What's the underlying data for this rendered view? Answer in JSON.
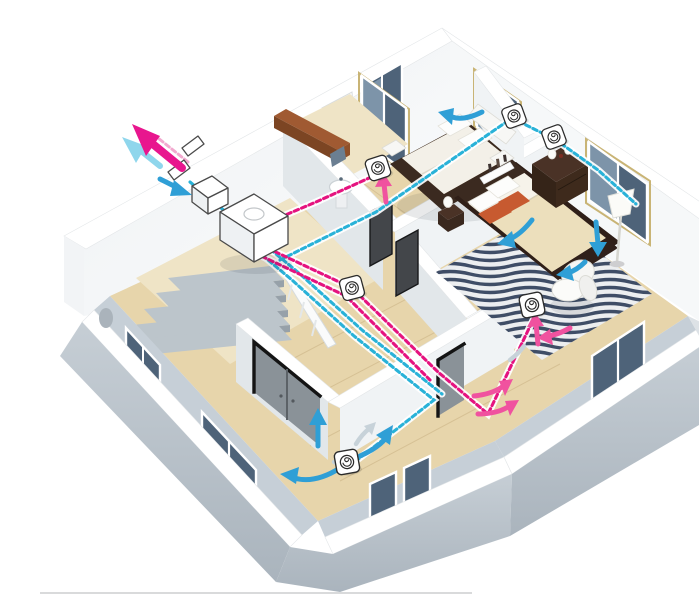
{
  "meta": {
    "alt": "3D cutaway illustration of a single-storey house interior showing a heat-recovery ventilation system: a white HRV unit near the entrance, cyan dashed supply-air ducts and magenta dashed extract-air ducts running over the cut wall tops, round ceiling diffusers in the hallway, bedrooms and living room, blue supply airflow arrows, pink extract airflow arrows, and exterior intake/exhaust arrows through the wall grilles",
    "visible_text": "none"
  },
  "colors": {
    "innerBand": "#c6cfd7",
    "backWall2": "#f6f8f9",
    "wallShade": "#e2e7ea",
    "wallShade2": "#f0f3f5",
    "floorWood": "#e7d5ab",
    "floorPale": "#efe4c6",
    "plank": "#c9b183",
    "glassDark": "#4e6379",
    "glassLight": "#7d94a9",
    "frameTan": "#c9b475",
    "stairTread": "#bcc5cb",
    "stairRiser": "#97a1a9",
    "doorPanel": "#8a9298",
    "doorFrame": "#141414",
    "supply": "#29b2d8",
    "supplyLight": "#8fd6ec",
    "extract": "#e5137f",
    "extractLight": "#f2a9cf",
    "extractBright": "#f0529f",
    "arrowBlue": "#2f9fd6",
    "arrowBlueLight": "#8fd6ec",
    "unitOutline": "#4a4a4a",
    "bedDark": "#3b2a20",
    "bedding": "#ecdfbc",
    "pillowOrange": "#c75a30",
    "rugNavy": "#3f4d66",
    "rugLight": "#eceef0",
    "watermarkLine": "#d9dadb"
  },
  "legend": {
    "supply_air": {
      "meaning": "fresh supply air duct / airflow",
      "color": "#29b2d8"
    },
    "extract_air": {
      "meaning": "stale extract air duct / airflow",
      "color": "#e5137f"
    },
    "room_airflow": {
      "meaning": "air movement inside rooms",
      "color": "#2f9fd6"
    }
  },
  "components": {
    "hrv_unit": "heat-recovery ventilation unit",
    "silencer_box": "duct connection box",
    "wall_grilles": 2,
    "supply_diffusers": 3,
    "extract_diffusers": 3,
    "exterior_exhaust_arrow": "magenta, pointing away from house",
    "exterior_intake_arrow": "cyan, pointing into wall grille"
  }
}
